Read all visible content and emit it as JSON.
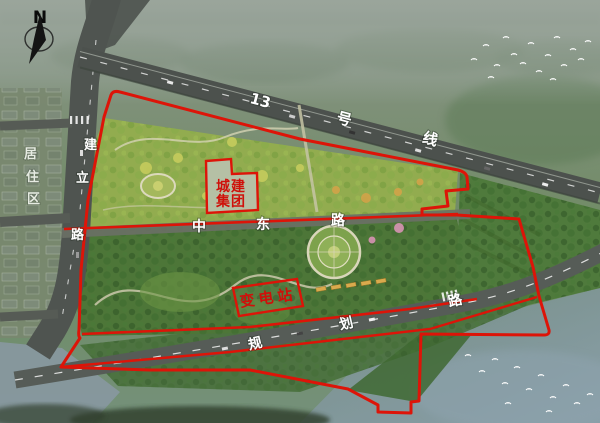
{
  "compass": {
    "north_label": "N"
  },
  "roads": {
    "metro_line_13": {
      "char_1": "13",
      "char_2": "号",
      "char_3": "线"
    },
    "jianli_road": {
      "char_1": "建",
      "char_2": "立",
      "char_3": "路"
    },
    "zhongdong_road": {
      "char_1": "中",
      "char_2": "东",
      "char_3": "路"
    },
    "guihua_road": {
      "char_1": "规",
      "char_2": "划",
      "char_3": "路"
    }
  },
  "areas": {
    "residential": {
      "char_1": "居",
      "char_2": "住",
      "char_3": "区"
    },
    "chengjian_group": {
      "line_1": "城建",
      "line_2": "集团"
    },
    "substation": {
      "label": "变电站"
    }
  },
  "colors": {
    "boundary_red": "#dd1408",
    "parcel_label_red": "#cf100a",
    "road_label_white": "#ffffff",
    "parcel_fill": "#b5c0a5"
  }
}
